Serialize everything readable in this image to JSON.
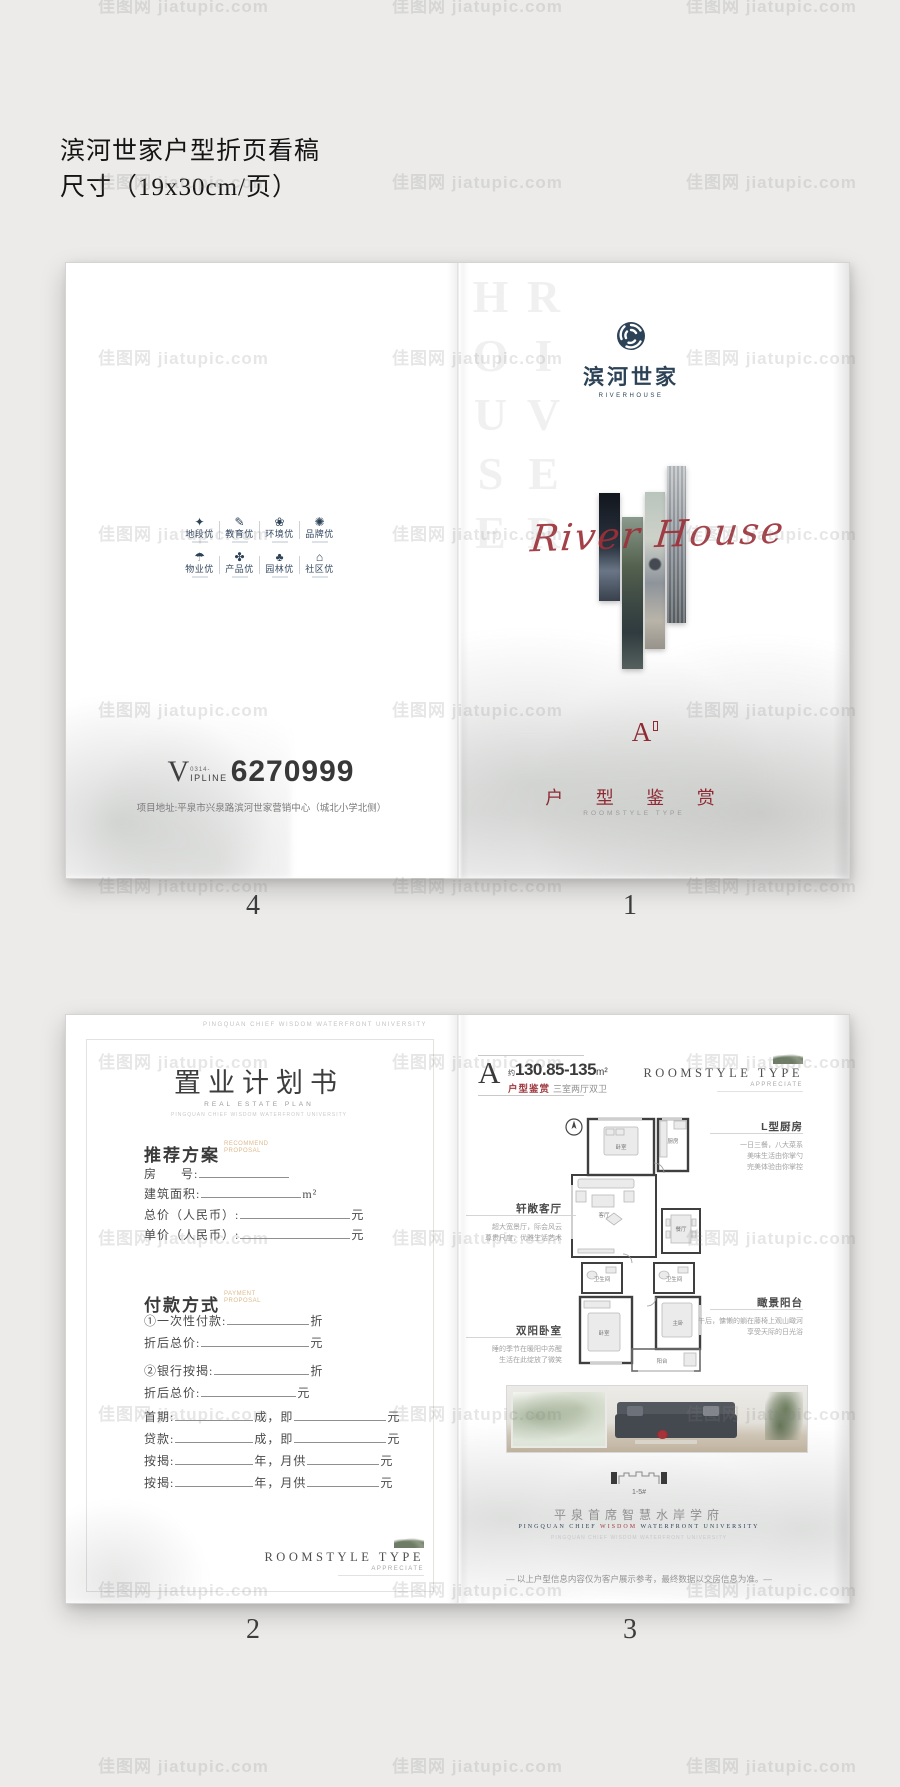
{
  "proof": {
    "line1": "滨河世家户型折页看稿",
    "line2": "尺寸（19x30cm/页）"
  },
  "watermark": {
    "text": "佳图网 jiatupic.com"
  },
  "colors": {
    "navy": "#2c4257",
    "script_red": "#9d3039",
    "title_red": "#8f2a33",
    "tan": "#dcba8f"
  },
  "pages": {
    "p4": {
      "page_no": "4",
      "features": [
        {
          "name": "location-icon",
          "glyph": "✦",
          "label": "地段优"
        },
        {
          "name": "education-icon",
          "glyph": "✎",
          "label": "教育优"
        },
        {
          "name": "environment-icon",
          "glyph": "❀",
          "label": "环境优"
        },
        {
          "name": "brand-icon",
          "glyph": "✺",
          "label": "品牌优"
        },
        {
          "name": "property-icon",
          "glyph": "☂",
          "label": "物业优"
        },
        {
          "name": "product-icon",
          "glyph": "✤",
          "label": "产品优"
        },
        {
          "name": "garden-icon",
          "glyph": "♣",
          "label": "园林优"
        },
        {
          "name": "community-icon",
          "glyph": "⌂",
          "label": "社区优"
        }
      ],
      "vip_v": "V",
      "vip_area": "0314-",
      "vip_label": "IPLINE",
      "vip_number": "6270999",
      "address": "项目地址:平泉市兴泉路滨河世家营销中心（城北小学北侧）"
    },
    "p1": {
      "page_no": "1",
      "bg_vertical": "RIVER HOUSE",
      "logo_cn": "滨河世家",
      "logo_en": "RIVERHOUSE",
      "script": "River House",
      "type_letter": "A",
      "title_cn": "户 型 鉴 赏",
      "title_en": "ROOMSTYLE TYPE"
    },
    "p2": {
      "page_no": "2",
      "top_caption": "PINGQUAN CHIEF WISDOM WATERFRONT UNIVERSITY",
      "title": "置业计划书",
      "subtitle": "REAL ESTATE PLAN",
      "subtitle2": "PINGQUAN CHIEF WISDOM WATERFRONT UNIVERSITY",
      "sections": [
        {
          "heading": "推荐方案",
          "heading_en": "RECOMMEND PROPOSAL",
          "rows": [
            [
              "房",
              {
                "sp": 24
              },
              "号:",
              {
                "b": 90
              }
            ],
            [
              "建筑面积:",
              {
                "b": 100
              },
              "m²"
            ],
            [
              "总价（人民币）:",
              {
                "b": 110
              },
              "元"
            ],
            [
              "单价（人民币）:",
              {
                "b": 110
              },
              "元"
            ]
          ]
        },
        {
          "heading": "付款方式",
          "heading_en": "PAYMENT PROPOSAL",
          "rows": [
            [
              "①一次性付款:",
              {
                "b": 82
              },
              "折"
            ],
            [
              "折后总价:",
              {
                "b": 108
              },
              "元"
            ],
            [
              "②银行按揭:",
              {
                "b": 95
              },
              "折"
            ],
            [
              "折后总价:",
              {
                "b": 95
              },
              "元"
            ],
            [
              "首期:",
              {
                "b": 78
              },
              "成，即",
              {
                "b": 92
              },
              "元"
            ],
            [
              "贷款:",
              {
                "b": 78
              },
              "成，即",
              {
                "b": 92
              },
              "元"
            ],
            [
              "按揭:",
              {
                "b": 78
              },
              "年，月供",
              {
                "b": 72
              },
              "元"
            ],
            [
              "按揭:",
              {
                "b": 78
              },
              "年，月供",
              {
                "b": 72
              },
              "元"
            ]
          ]
        }
      ],
      "corner_line1": "ROOMSTYLE TYPE",
      "corner_line2": "APPRECIATE"
    },
    "p3": {
      "page_no": "3",
      "header": {
        "letter": "A",
        "approx": "约",
        "area": "130.85-135",
        "unit": "m²",
        "cat_red": "户型鉴赏",
        "cat_gray": "三室两厅双卫"
      },
      "corner_line1": "ROOMSTYLE TYPE",
      "corner_line2": "APPRECIATE",
      "plan": {
        "bedroom_top": "卧室",
        "kitchen": "厨房",
        "living": "客厅",
        "dining": "餐厅",
        "bath1": "卫生间",
        "bath2": "卫生间",
        "bedroom_bottom": "卧室",
        "master": "主卧",
        "balcony": "阳台"
      },
      "ann_left": [
        {
          "title": "轩敞客厅",
          "lines": [
            "超大宽景厅，际会风云",
            "尊贵尺度，优雅生活艺术"
          ]
        },
        {
          "title": "双阳卧室",
          "lines": [
            "睡的季节在暖阳中苏醒",
            "生活在此绽放了微笑"
          ]
        }
      ],
      "ann_right": [
        {
          "title": "L型厨房",
          "lines": [
            "一日三餐，八大菜系",
            "美味生活由你掌勺",
            "完美体验由你掌控"
          ]
        },
        {
          "title": "瞰景阳台",
          "lines": [
            "午后，慵懒的躺在藤椅上观山瞰河",
            "享受天际的日光浴"
          ]
        }
      ],
      "building_label": "1-5#",
      "slogan": "平泉首席智慧水岸学府",
      "slogan_en_left": "PINGQUAN CHIEF",
      "slogan_en_mid": "WISDOM",
      "slogan_en_right": "WATERFRONT UNIVERSITY",
      "micro": "PINGQUAN CHIEF WISDOM WATERFRONT UNIVERSITY",
      "disclaimer": "— 以上户型信息内容仅为客户展示参考，最终数据以交房信息为准。—"
    }
  }
}
